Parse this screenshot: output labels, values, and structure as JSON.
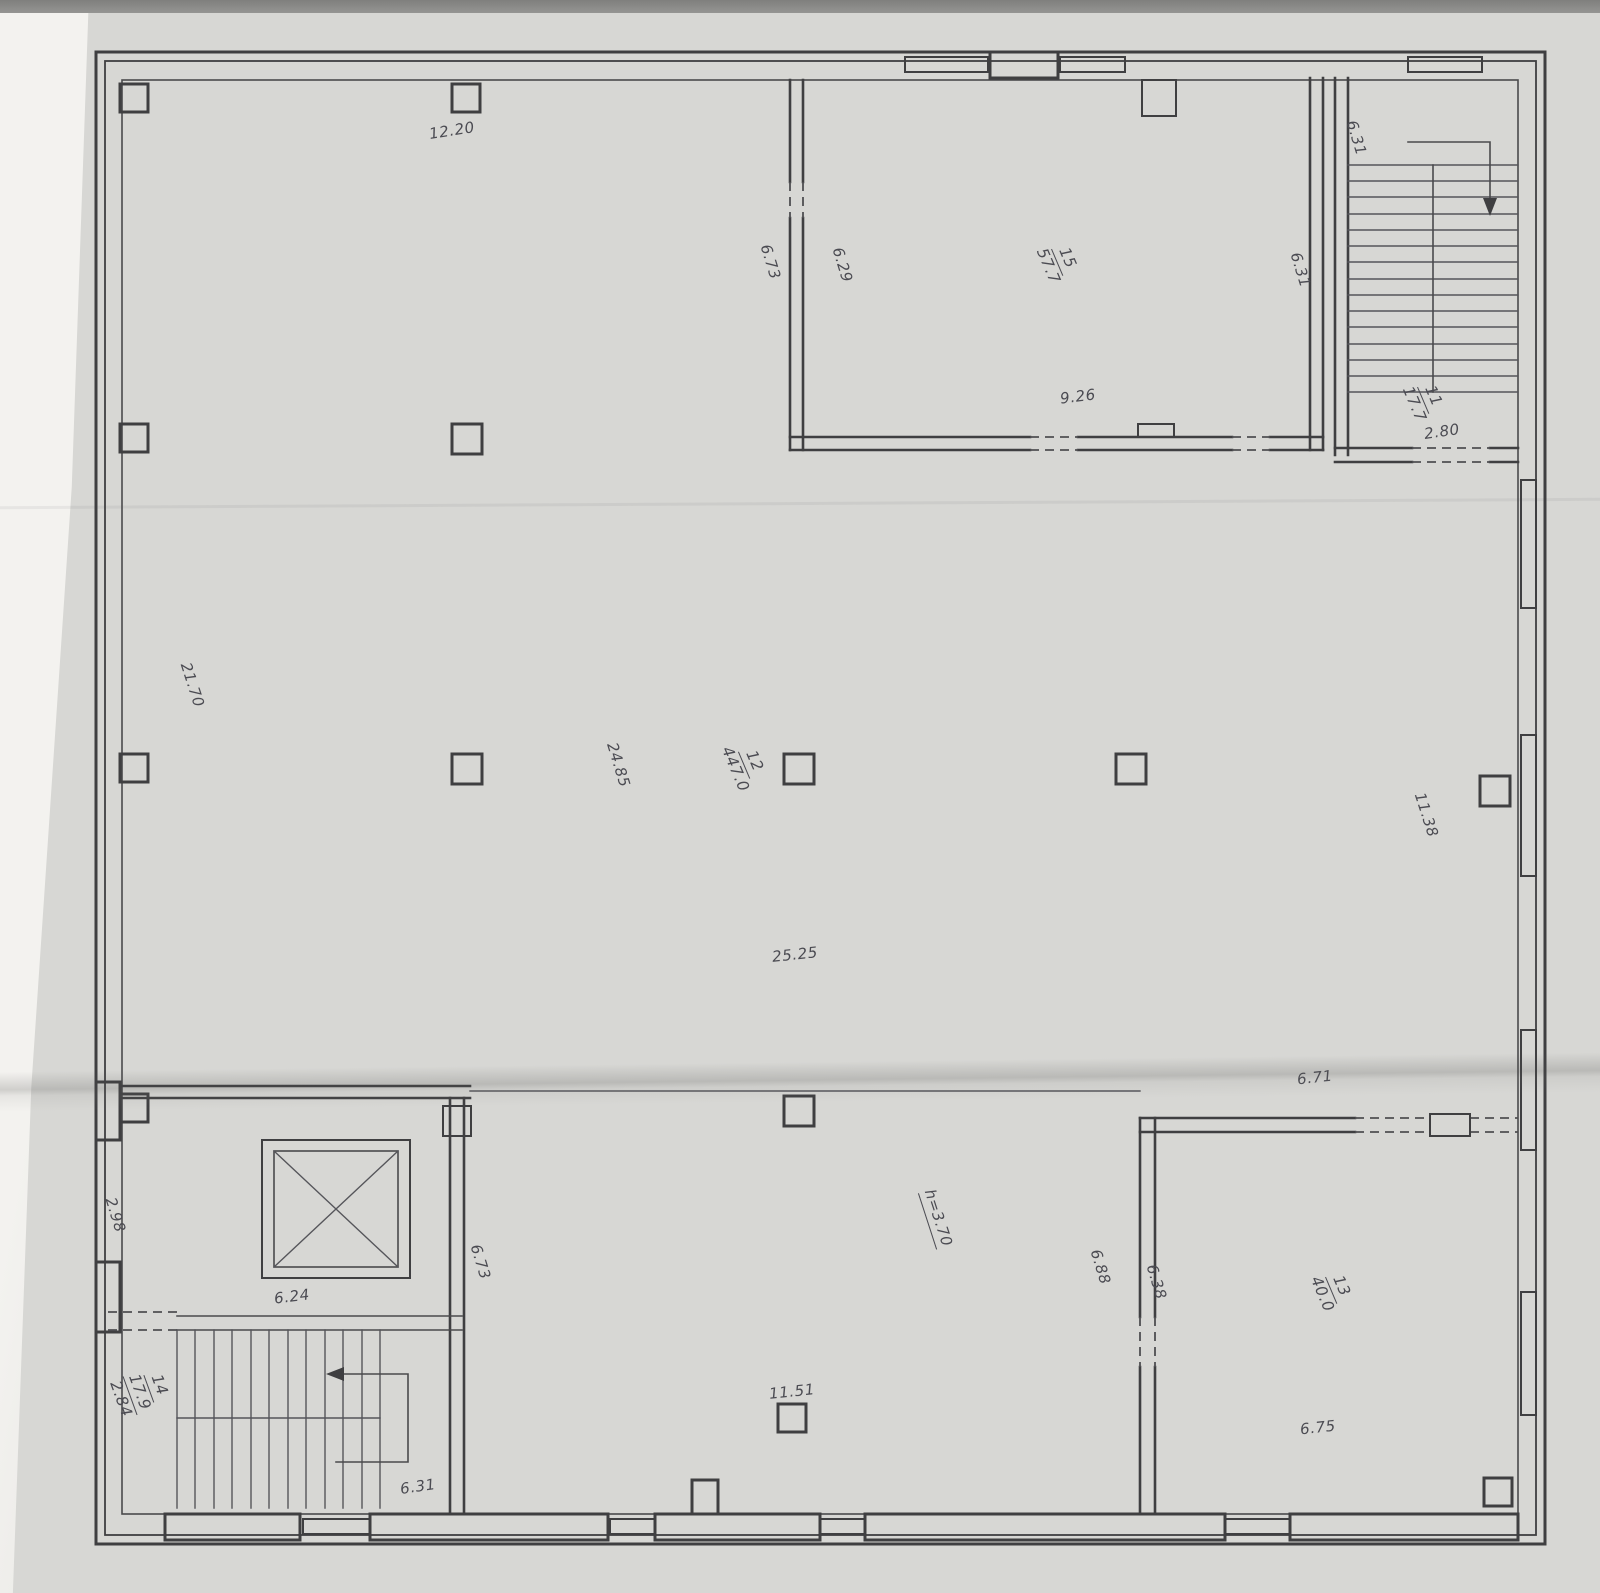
{
  "document": {
    "kind": "scanned architectural floor plan",
    "ink_color": "#3f3f41",
    "paper_color": "#d7d7d4",
    "rooms": [
      {
        "number": "11",
        "area_m2": "17.7",
        "type": "stairwell-top-right"
      },
      {
        "number": "12",
        "area_m2": "447.0",
        "type": "main-hall"
      },
      {
        "number": "13",
        "area_m2": "40.0",
        "type": "room-bottom-right"
      },
      {
        "number": "14",
        "area_m2": "17.9",
        "type": "stairwell-bottom-left"
      },
      {
        "number": "15",
        "area_m2": "57.7",
        "type": "room-top-center"
      }
    ],
    "ceiling_height_note": "h=3.70"
  },
  "labels": {
    "top_span": "12.20",
    "r15_wall_out": "6.73",
    "r15_wall_in": "6.29",
    "r15_num": "15",
    "r15_den": "57.7",
    "r15_right": "6.31",
    "tr_stair_width": "6.31",
    "r15_bottom": "9.26",
    "tr_num": "11",
    "tr_den": "17.7",
    "tr_door": "2.80",
    "hall_left": "21.70",
    "hall_mid": "24.85",
    "hall_num": "12",
    "hall_den": "447.0",
    "hall_bottom": "25.25",
    "hall_right": "11.38",
    "r13_top": "6.71",
    "bl_left": "2.98",
    "lift_width": "6.24",
    "bl_corridor": "6.73",
    "height_note": "h=3.70",
    "r13_out": "6.88",
    "r13_in": "6.38",
    "r13_num": "13",
    "r13_den": "40.0",
    "bl_num": "14",
    "bl_den": "17.9",
    "bl_extra": "2.84",
    "bc_bottom": "11.51",
    "bl_stair_width": "6.31",
    "r13_bottom": "6.75"
  }
}
